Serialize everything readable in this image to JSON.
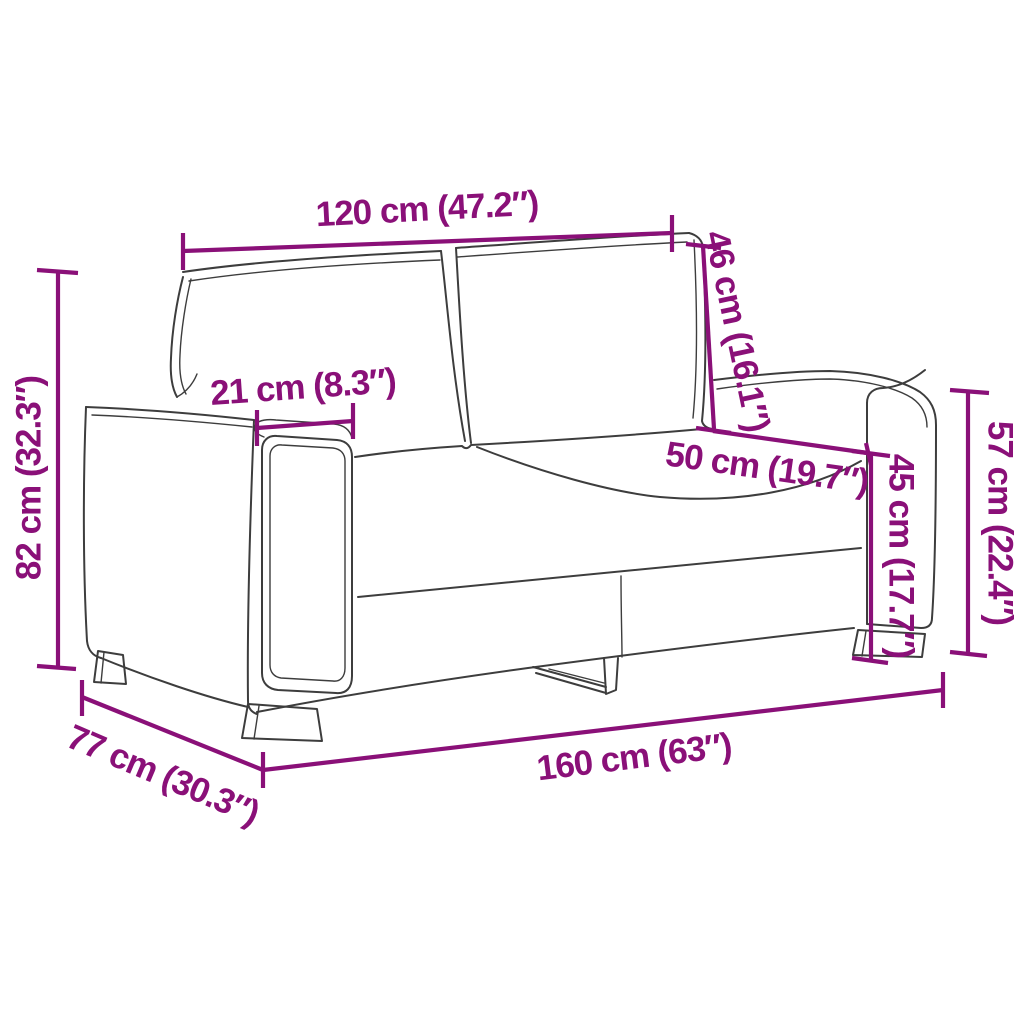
{
  "diagram": {
    "type": "product-dimension-diagram",
    "subject": "2-seater sofa line drawing",
    "accent_color": "#8A1078",
    "outline_color": "#3D3D3D",
    "background_color": "#FFFFFF",
    "dimensions": {
      "back_width": "120 cm (47.2″)",
      "backrest_height": "46 cm (16.1″)",
      "armrest_width": "21 cm (8.3″)",
      "seat_depth": "50 cm (19.7″)",
      "seat_height": "45 cm (17.7″)",
      "armrest_height": "57 cm (22.4″)",
      "total_height": "82 cm (32.3″)",
      "depth": "77 cm (30.3″)",
      "total_width": "160 cm (63″)"
    }
  }
}
